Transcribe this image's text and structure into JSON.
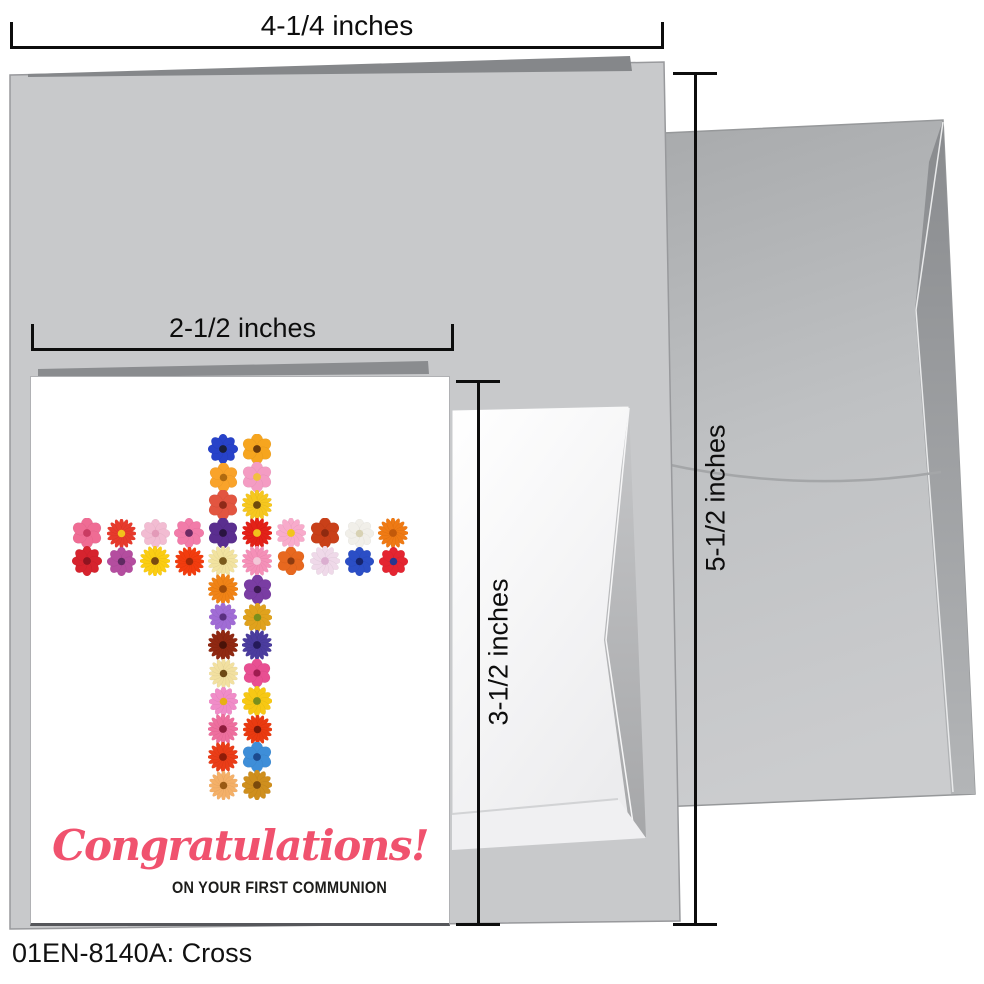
{
  "dimensions": {
    "width_large": "4-1/4 inches",
    "width_small": "2-1/2 inches",
    "height_small": "3-1/2 inches",
    "height_large": "5-1/2 inches"
  },
  "card": {
    "greeting_script": "Congratulations!",
    "greeting_sub": "ON YOUR FIRST COMMUNION",
    "script_color": "#f0526e",
    "sub_color": "#1d1d1b"
  },
  "footer": {
    "label": "01EN-8140A: Cross"
  },
  "colors": {
    "card_back_gray": "#c8c9cb",
    "fold_dark_gray": "#85878a",
    "envelope_gray_top": "#a8aaac",
    "envelope_gray_bottom": "#cbccce",
    "dimension_line": "#0d0d0d",
    "card_front_white": "#ffffff"
  },
  "flower_cross": {
    "description": "cross shape made of flowers, 10 columns x 13 rows grid",
    "arm_rows": [
      3,
      4
    ],
    "center_columns": [
      4,
      5
    ],
    "flowers": [
      [
        0,
        4,
        "a",
        "#2742c9",
        "#1a1f3c",
        30
      ],
      [
        0,
        5,
        "p",
        "#f6a51f",
        "#6e3c0a",
        30
      ],
      [
        1,
        4,
        "p",
        "#f9a32a",
        "#b06a10",
        29
      ],
      [
        1,
        5,
        "p",
        "#f49cc3",
        "#f2c040",
        30
      ],
      [
        2,
        4,
        "p",
        "#e25540",
        "#8f2a18",
        30
      ],
      [
        2,
        5,
        "g",
        "#f6c71f",
        "#6e4a0c",
        30
      ],
      [
        3,
        0,
        "p",
        "#ef6c94",
        "#c93b62",
        30
      ],
      [
        3,
        1,
        "g",
        "#e73a2c",
        "#f2c21c",
        29
      ],
      [
        3,
        2,
        "a",
        "#f2bcd2",
        "#e39ab8",
        29
      ],
      [
        3,
        3,
        "a",
        "#f27ba9",
        "#6e2a64",
        30
      ],
      [
        3,
        4,
        "p",
        "#5a2e8f",
        "#2a1440",
        30
      ],
      [
        3,
        5,
        "g",
        "#e32118",
        "#f2c21c",
        30
      ],
      [
        3,
        6,
        "d",
        "#f8abcb",
        "#f2c51c",
        30
      ],
      [
        3,
        7,
        "p",
        "#c94019",
        "#8f2a10",
        30
      ],
      [
        3,
        8,
        "a",
        "#f1efe9",
        "#d8d2b4",
        29
      ],
      [
        3,
        9,
        "g",
        "#ef7a14",
        "#c2590a",
        30
      ],
      [
        4,
        0,
        "a",
        "#d6232e",
        "#8f1420",
        30
      ],
      [
        4,
        1,
        "a",
        "#b44d9f",
        "#5f2a62",
        29
      ],
      [
        4,
        2,
        "g",
        "#fbcd13",
        "#7a4a10",
        30
      ],
      [
        4,
        3,
        "g",
        "#f23c0e",
        "#a02808",
        29
      ],
      [
        4,
        4,
        "g",
        "#f2e3a0",
        "#7a5a1c",
        30
      ],
      [
        4,
        5,
        "g",
        "#f590b8",
        "#f3c7d8",
        30
      ],
      [
        4,
        6,
        "p",
        "#e7681f",
        "#8f3c10",
        28
      ],
      [
        4,
        7,
        "d",
        "#efd9e9",
        "#dbaed0",
        30
      ],
      [
        4,
        8,
        "a",
        "#2b4ec6",
        "#16246e",
        29
      ],
      [
        4,
        9,
        "a",
        "#e42531",
        "#28368f",
        29
      ],
      [
        5,
        4,
        "g",
        "#f08316",
        "#a04c08",
        30
      ],
      [
        5,
        5,
        "p",
        "#7a3da3",
        "#3c1a52",
        29
      ],
      [
        6,
        4,
        "d",
        "#a06cd5",
        "#5a3080",
        28
      ],
      [
        6,
        5,
        "d",
        "#e0a21d",
        "#7a8f1c",
        29
      ],
      [
        7,
        4,
        "g",
        "#8f2812",
        "#4a1208",
        30
      ],
      [
        7,
        5,
        "g",
        "#4b3c9e",
        "#241a5a",
        30
      ],
      [
        8,
        4,
        "g",
        "#f2e0a0",
        "#6e4a14",
        29
      ],
      [
        8,
        5,
        "p",
        "#e84f92",
        "#a01c50",
        28
      ],
      [
        9,
        4,
        "d",
        "#f08cc8",
        "#e8b014",
        29
      ],
      [
        9,
        5,
        "d",
        "#f7c814",
        "#7a8f1c",
        30
      ],
      [
        10,
        4,
        "g",
        "#ee6f9e",
        "#8f1c3c",
        30
      ],
      [
        10,
        5,
        "g",
        "#ea3a10",
        "#7a1808",
        29
      ],
      [
        11,
        4,
        "g",
        "#ea3d18",
        "#8f1c08",
        30
      ],
      [
        11,
        5,
        "p",
        "#3e8ed8",
        "#1c4a8f",
        30
      ],
      [
        12,
        4,
        "g",
        "#f4b068",
        "#9a5a14",
        29
      ],
      [
        12,
        5,
        "d",
        "#cf8f1e",
        "#7a4a0c",
        30
      ]
    ]
  }
}
